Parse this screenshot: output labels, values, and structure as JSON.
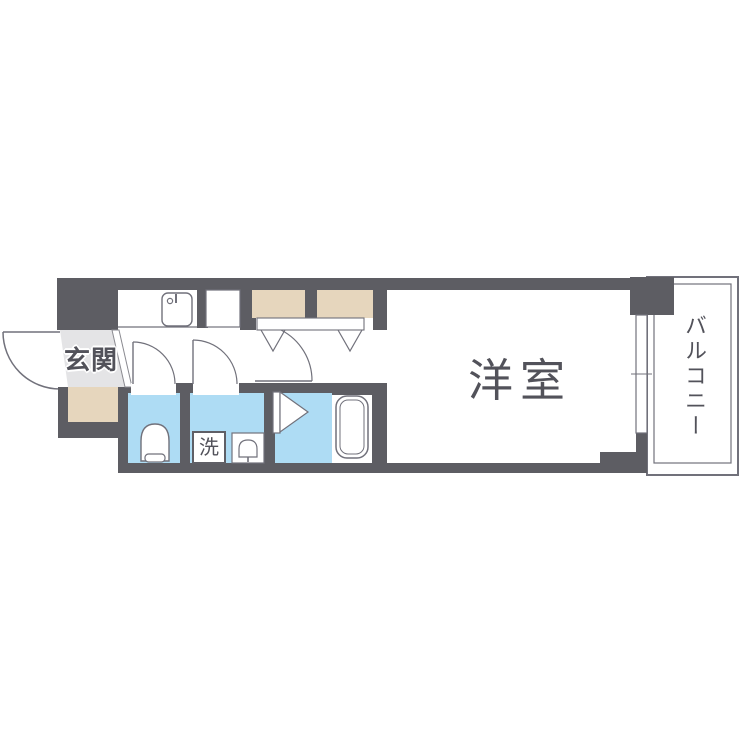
{
  "palette": {
    "wall": "#5d5d63",
    "water_room": "#aedcf4",
    "storage": "#e6d6bd",
    "entrance_floor": "#e4e4e6",
    "line": "#71717b",
    "label_text": "#52525a"
  },
  "labels": {
    "entrance": "玄関",
    "western_room": "洋室",
    "balcony": "バルコニー",
    "washer": "洗"
  },
  "fixtures": [
    "kitchen-sink-icon",
    "refrigerator-space",
    "closet",
    "closet-folding-doors",
    "toilet-icon",
    "washing-machine-space",
    "washbasin-icon",
    "bath-door-icon",
    "bathtub-icon",
    "sliding-window",
    "entrance-door-swing",
    "interior-door-swing"
  ]
}
